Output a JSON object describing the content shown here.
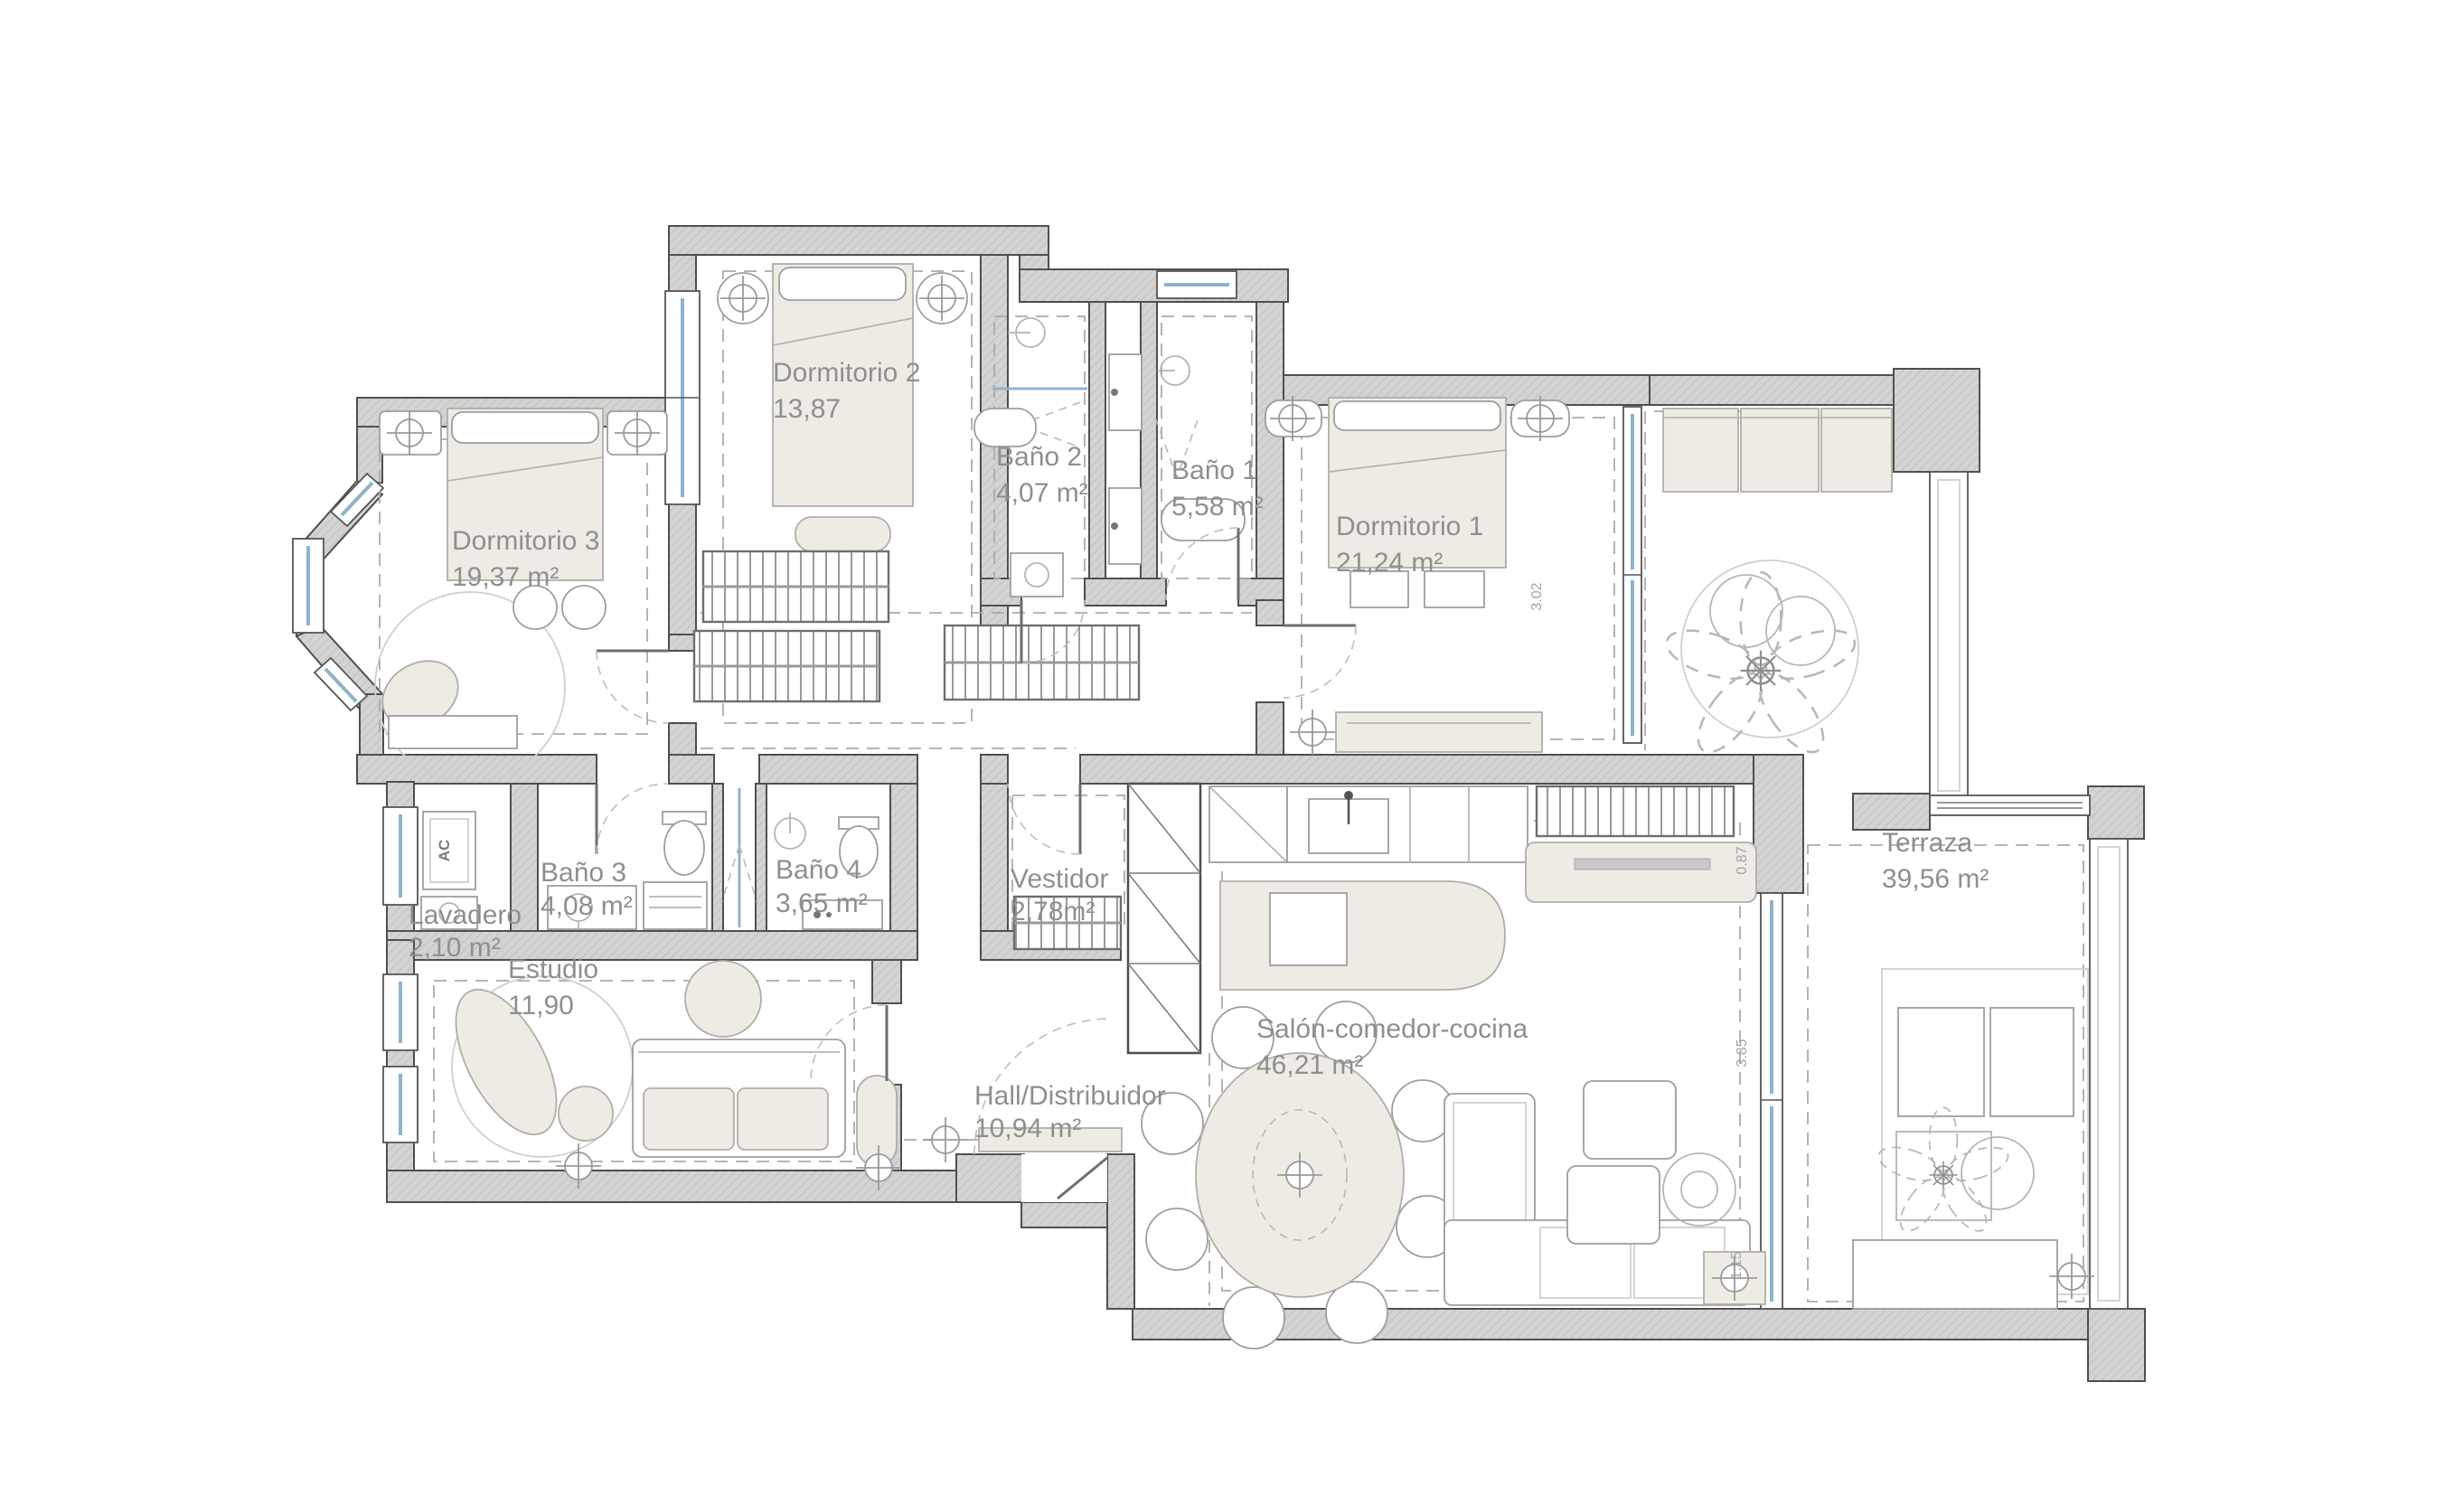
{
  "plan": {
    "rooms": [
      {
        "name": "Dormitorio 2",
        "area": "13,87"
      },
      {
        "name": "Baño 2",
        "area": "4,07 m²"
      },
      {
        "name": "Baño 1",
        "area": "5,58 m²"
      },
      {
        "name": "Dormitorio 1",
        "area": "21,24 m²"
      },
      {
        "name": "Dormitorio 3",
        "area": "19,37 m²"
      },
      {
        "name": "Lavadero",
        "area": "2,10 m²"
      },
      {
        "name": "Baño 3",
        "area": "4,08 m²"
      },
      {
        "name": "Baño 4",
        "area": "3,65 m²"
      },
      {
        "name": "Vestidor",
        "area": "2,78m²"
      },
      {
        "name": "Estudio",
        "area": "11,90"
      },
      {
        "name": "Hall/Distribuidor",
        "area": "10,94 m²"
      },
      {
        "name": "Salón-comedor-cocina",
        "area": "46,21 m²"
      },
      {
        "name": "Terraza",
        "area": "39,56 m²"
      }
    ],
    "dimensions": {
      "dorm1_window": "3.02",
      "salon_right_top": "0.87",
      "salon_right_window": "3.85",
      "salon_right_bottom": "1.15"
    },
    "labels": {
      "ac_unit": "AC"
    },
    "colors": {
      "wall": "#d3d3d3",
      "wall_hatch": "#c2c2c2",
      "wall_outline": "#4f4f4f",
      "furniture_beige": "#edebe3",
      "glazing_blue": "#8fb3cc",
      "text_gray": "#8f8f8f",
      "background": "#ffffff"
    }
  }
}
